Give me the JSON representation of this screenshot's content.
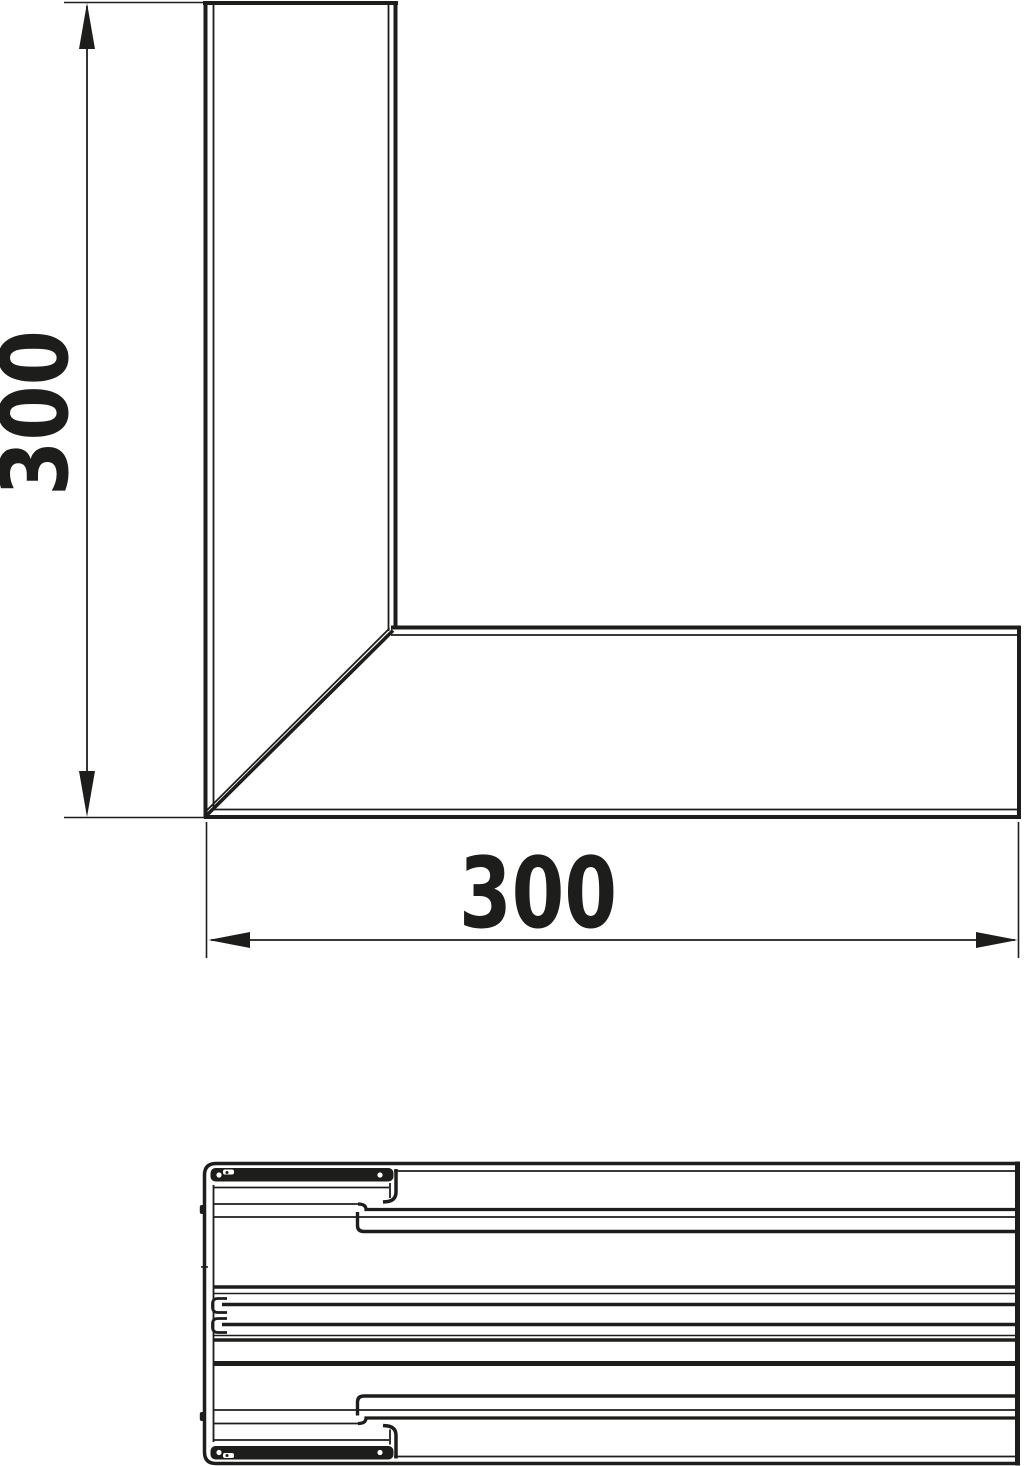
{
  "drawing": {
    "background_color": "#ffffff",
    "line_color": "#1d1d1b"
  },
  "dimensions": {
    "vertical": {
      "label": "300"
    },
    "horizontal": {
      "label": "300"
    }
  }
}
